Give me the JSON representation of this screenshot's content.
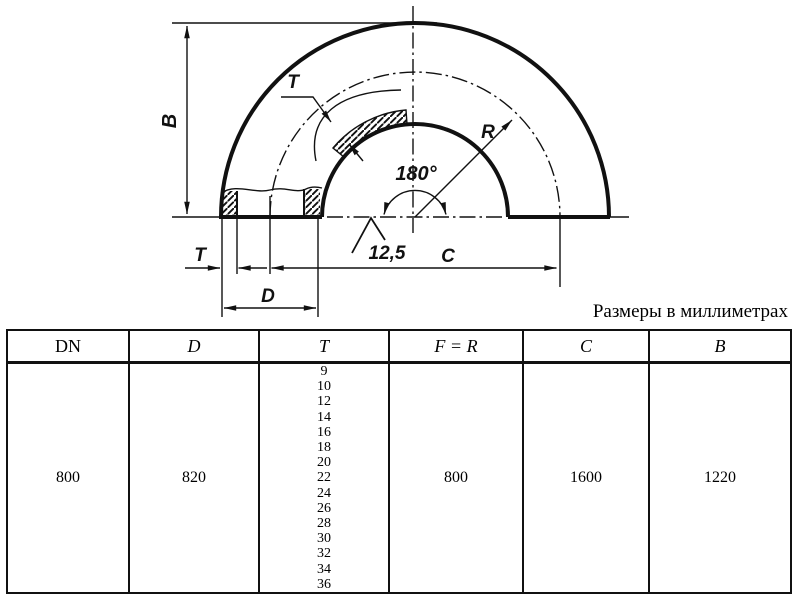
{
  "caption": "Размеры в миллиметрах",
  "drawing": {
    "line_color": "#111111",
    "dim_B_label": "B",
    "wall_T_label": "T",
    "radius_label": "R",
    "angle_label": "180°",
    "roughness_value": "12,5",
    "dim_T_label": "T",
    "dim_D_label": "D",
    "dim_C_label": "C"
  },
  "table": {
    "headers": [
      "DN",
      "D",
      "T",
      "F = R",
      "C",
      "B"
    ],
    "row": {
      "dn": "800",
      "d": "820",
      "t_values": [
        "9",
        "10",
        "12",
        "14",
        "16",
        "18",
        "20",
        "22",
        "24",
        "26",
        "28",
        "30",
        "32",
        "34",
        "36"
      ],
      "f_eq_r": "800",
      "c": "1600",
      "b": "1220"
    }
  }
}
